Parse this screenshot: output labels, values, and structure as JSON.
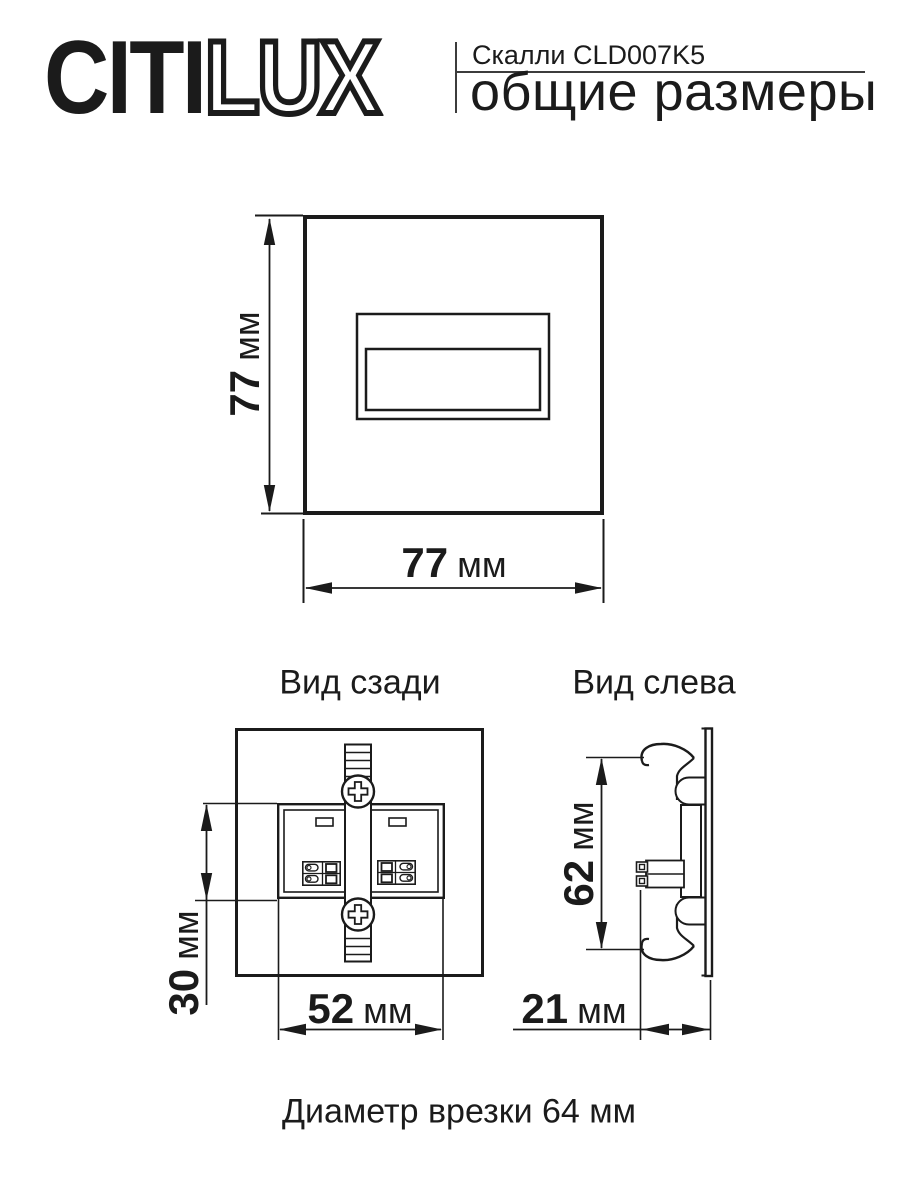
{
  "colors": {
    "line": "#1b1b1b",
    "background": "#ffffff"
  },
  "header": {
    "logo": {
      "part_solid": "CITI",
      "part_outline": "LUX"
    },
    "model": "Скалли CLD007K5",
    "subtitle": "общие размеры"
  },
  "front_view": {
    "height_dim": {
      "value": "77",
      "unit": "мм"
    },
    "width_dim": {
      "value": "77",
      "unit": "мм"
    }
  },
  "rear_view": {
    "title": "Вид сзади",
    "screw_icon": "phillips-screw",
    "height_dim": {
      "value": "30",
      "unit": "мм"
    },
    "width_dim": {
      "value": "52",
      "unit": "мм"
    }
  },
  "left_view": {
    "title": "Вид слева",
    "height_dim": {
      "value": "62",
      "unit": "мм"
    },
    "depth_dim": {
      "value": "21",
      "unit": "мм"
    }
  },
  "footer": {
    "note": "Диаметр врезки 64 мм"
  }
}
